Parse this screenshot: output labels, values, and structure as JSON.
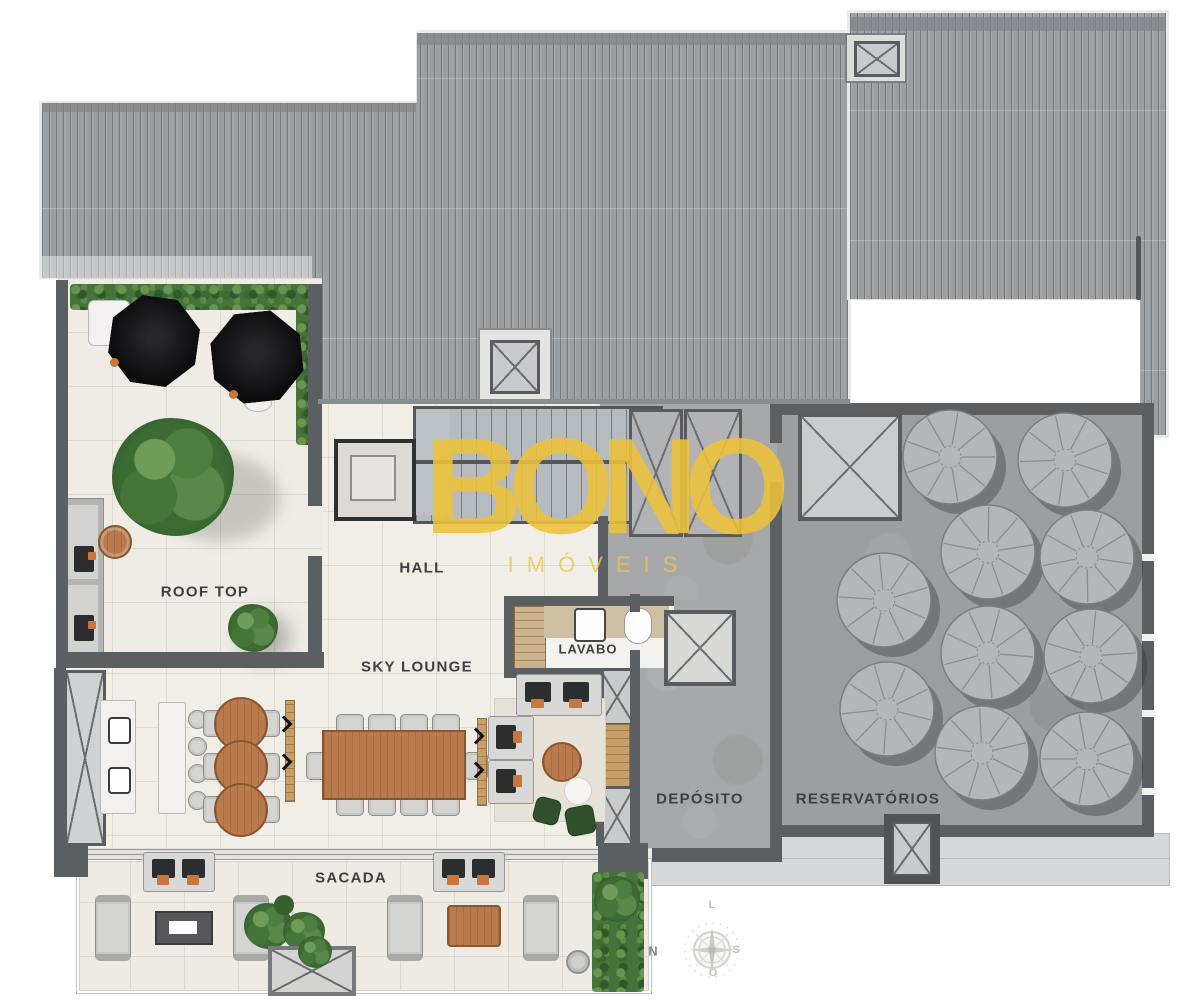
{
  "plan": {
    "type": "floor-plan",
    "rooms": {
      "roof_top": "ROOF TOP",
      "hall": "HALL",
      "sky_lounge": "SKY LOUNGE",
      "lavabo": "LAVABO",
      "sacada": "SACADA",
      "deposito": "DEPÓSITO",
      "reservatorios": "RESERVATÓRIOS"
    },
    "reservoir_tank_count": 10
  },
  "watermark": {
    "brand": "BONO",
    "subtitle": "IMÓVEIS"
  },
  "compass": {
    "north": "N",
    "east": "L",
    "south": "S",
    "west": "O"
  },
  "colors": {
    "accent_yellow": "#EDC23A",
    "roof_gray": "#9CA0A3",
    "concrete_gray": "#A7A8A9",
    "floor_cream": "#F1EEE7",
    "wall_dark": "#5C5F62",
    "wood": "#B97A4E",
    "greenery": "#46733C",
    "umbrella_black": "#0D0D0F"
  }
}
